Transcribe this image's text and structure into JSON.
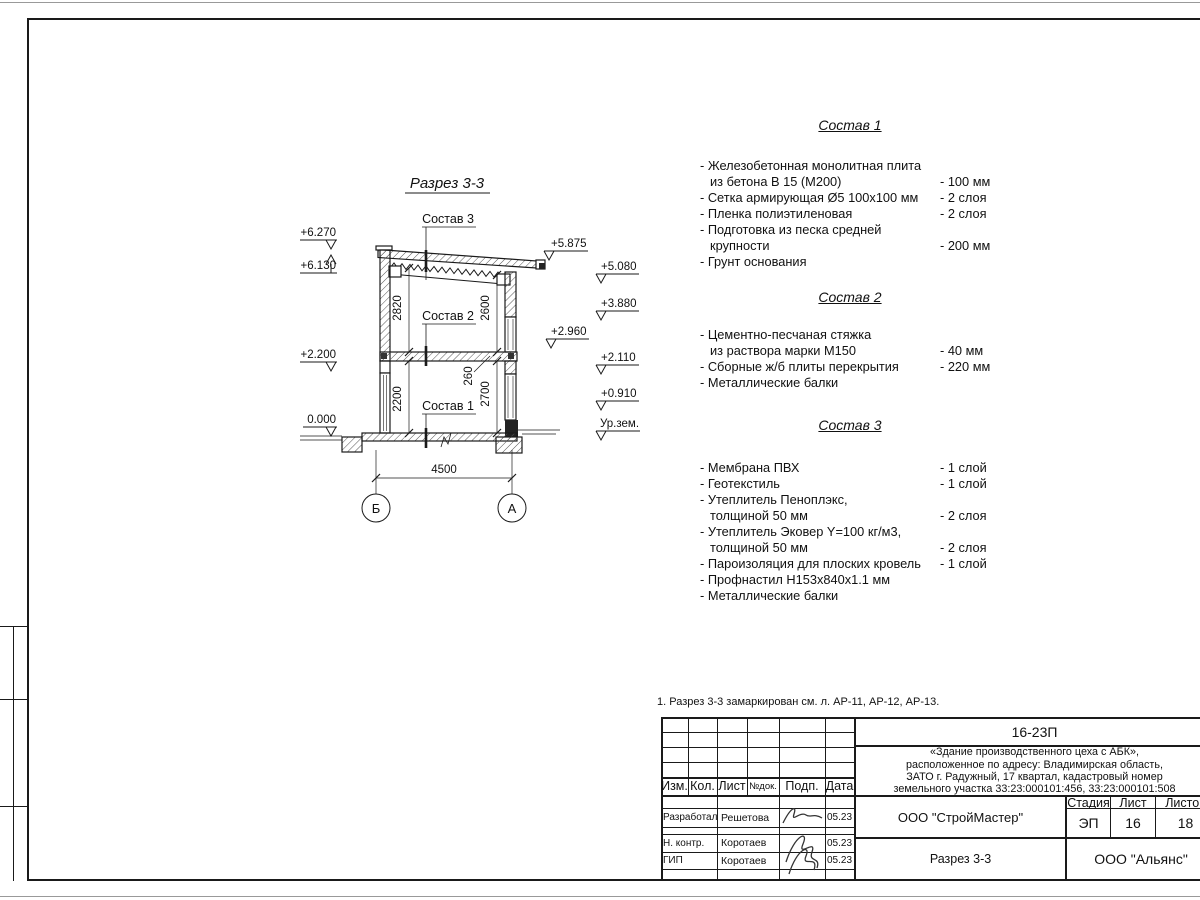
{
  "drawing": {
    "title": "Разрез 3-3",
    "labels": {
      "s1": "Состав 1",
      "s2": "Состав 2",
      "s3": "Состав 3"
    },
    "elevations": {
      "e6270": "+6.270",
      "e6130": "+6.130",
      "e2200": "+2.200",
      "e0000": "0.000",
      "e5875": "+5.875",
      "e5080": "+5.080",
      "e3880": "+3.880",
      "e2960": "+2.960",
      "e2110": "+2.110",
      "e0910": "+0.910",
      "ground": "Ур.зем."
    },
    "dims": {
      "d2820": "2820",
      "d2600": "2600",
      "d2200": "2200",
      "d2700": "2700",
      "d260": "260",
      "d4500": "4500"
    },
    "axes": {
      "left": "Б",
      "right": "А"
    }
  },
  "sections": [
    {
      "title": "Состав 1",
      "items": [
        {
          "line1": "- Железобетонная  монолитная плита",
          "line2": "из бетона В 15 (М200)",
          "value": "- 100 мм"
        },
        {
          "line1": "- Сетка армирующая Ø5 100х100 мм",
          "line2": "",
          "value": "- 2 слоя"
        },
        {
          "line1": "- Пленка полиэтиленовая",
          "line2": "",
          "value": "- 2 слоя"
        },
        {
          "line1": "- Подготовка из песка средней",
          "line2": "крупности",
          "value": "- 200 мм"
        },
        {
          "line1": "- Грунт основания",
          "line2": "",
          "value": ""
        }
      ]
    },
    {
      "title": "Состав 2",
      "items": [
        {
          "line1": "- Цементно-песчаная стяжка",
          "line2": "из раствора марки М150",
          "value": "- 40 мм"
        },
        {
          "line1": "- Сборные ж/б плиты перекрытия",
          "line2": "",
          "value": "- 220 мм"
        },
        {
          "line1": "- Металлические балки",
          "line2": "",
          "value": ""
        }
      ]
    },
    {
      "title": "Состав 3",
      "items": [
        {
          "line1": "- Мембрана ПВХ",
          "line2": "",
          "value": "- 1 слой"
        },
        {
          "line1": "- Геотекстиль",
          "line2": "",
          "value": "- 1 слой"
        },
        {
          "line1": "- Утеплитель Пеноплэкс,",
          "line2": "толщиной 50 мм",
          "value": "- 2 слоя"
        },
        {
          "line1": "- Утеплитель Эковер Y=100 кг/м3,",
          "line2": "толщиной 50 мм",
          "value": "- 2 слоя"
        },
        {
          "line1": "- Пароизоляция для плоских кровель",
          "line2": "",
          "value": "- 1 слой"
        },
        {
          "line1": "- Профнастил Н153х840х1.1 мм",
          "line2": "",
          "value": ""
        },
        {
          "line1": "- Металлические балки",
          "line2": "",
          "value": ""
        }
      ]
    }
  ],
  "note": "1. Разрез 3-3 замаркирован см. л. АР-11, АР-12, АР-13.",
  "titleblock": {
    "doc_number": "16-23П",
    "description_lines": [
      "«Здание производственного цеха с АБК»,",
      "расположенное по адресу: Владимирская область,",
      "ЗАТО г. Радужный, 17 квартал, кадастровый номер",
      "земельного участка 33:23:000101:456, 33:23:000101:508"
    ],
    "cols": {
      "izm": "Изм.",
      "kol": "Кол.",
      "list": "Лист",
      "ndok": "№док.",
      "podp": "Подп.",
      "data": "Дата"
    },
    "rows": [
      {
        "role": "Разработал",
        "name": "Решетова",
        "date": "05.23"
      },
      {
        "role": "Н. контр.",
        "name": "Коротаев",
        "date": "05.23"
      },
      {
        "role": "ГИП",
        "name": "Коротаев",
        "date": "05.23"
      }
    ],
    "stage_label": "Стадия",
    "sheet_label": "Лист",
    "sheets_label": "Листов",
    "stage": "ЭП",
    "sheet": "16",
    "sheets": "18",
    "org1": "ООО \"СтройМастер\"",
    "view_name": "Разрез 3-3",
    "org2": "ООО \"Альянс\""
  },
  "colors": {
    "line": "#1a1a1a",
    "hatch": "#555555",
    "paper": "#ffffff"
  }
}
